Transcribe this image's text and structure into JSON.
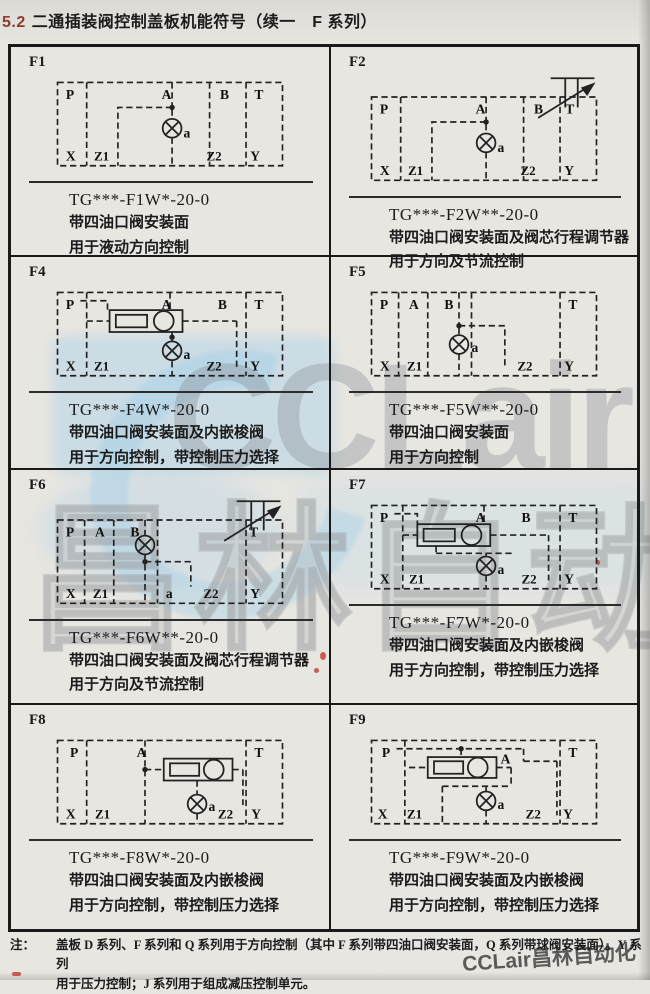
{
  "page": {
    "background": "#e7e6e1",
    "table_border": "#1a1a1a",
    "accent_num_color": "#8a3c2e"
  },
  "header": {
    "num": "5.2",
    "title": "二通插装阀控制盖板机能符号（续一　F 系列）"
  },
  "watermark": {
    "brand": "CCLair",
    "brand_cn": "昌林自动化",
    "corner": "CCLair昌林自动化",
    "blue": "#9ecdec",
    "gray": "#80868c"
  },
  "note": {
    "prefix": "注：",
    "line1": "盖板 D 系列、F 系列和 Q 系列用于方向控制（其中 F 系列带四油口阀安装面，Q 系列带球阀安装面）。Y 系列",
    "line2": "用于压力控制；J 系列用于组成减压控制单元。"
  },
  "cells": [
    {
      "id": "F1",
      "model": "TG***-F1W*-20-0",
      "desc1": "带四油口阀安装面",
      "desc2": "用于液动方向控制",
      "ports": {
        "p": "P",
        "a_top": "A",
        "b": "B",
        "t": "T",
        "x": "X",
        "z1": "Z1",
        "a": "a",
        "z2": "Z2",
        "y": "Y"
      }
    },
    {
      "id": "F2",
      "model": "TG***-F2W**-20-0",
      "desc1": "带四油口阀安装面及阀芯行程调节器",
      "desc2": "用于方向及节流控制",
      "ports": {
        "p": "P",
        "a_top": "A",
        "b": "B",
        "t": "T",
        "x": "X",
        "z1": "Z1",
        "a": "a",
        "z2": "Z2",
        "y": "Y"
      }
    },
    {
      "id": "F4",
      "model": "TG***-F4W*-20-0",
      "desc1": "带四油口阀安装面及内嵌梭阀",
      "desc2": "用于方向控制，带控制压力选择",
      "ports": {
        "p": "P",
        "a_top": "A",
        "b": "B",
        "t": "T",
        "x": "X",
        "z1": "Z1",
        "a": "a",
        "z2": "Z2",
        "y": "Y"
      }
    },
    {
      "id": "F5",
      "model": "TG***-F5W**-20-0",
      "desc1": "带四油口阀安装面",
      "desc2": "用于方向控制",
      "ports": {
        "p": "P",
        "a_top": "A",
        "b": "B",
        "t": "T",
        "x": "X",
        "z1": "Z1",
        "a": "a",
        "z2": "Z2",
        "y": "Y"
      }
    },
    {
      "id": "F6",
      "model": "TG***-F6W**-20-0",
      "desc1": "带四油口阀安装面及阀芯行程调节器",
      "desc2": "用于方向及节流控制",
      "ports": {
        "p": "P",
        "a_top": "A",
        "b": "B",
        "t": "T",
        "x": "X",
        "z1": "Z1",
        "a": "a",
        "z2": "Z2",
        "y": "Y"
      }
    },
    {
      "id": "F7",
      "model": "TG***-F7W*-20-0",
      "desc1": "带四油口阀安装面及内嵌梭阀",
      "desc2": "用于方向控制，带控制压力选择",
      "ports": {
        "p": "P",
        "a_top": "A",
        "b": "B",
        "t": "T",
        "x": "X",
        "z1": "Z1",
        "a": "a",
        "z2": "Z2",
        "y": "Y"
      }
    },
    {
      "id": "F8",
      "model": "TG***-F8W*-20-0",
      "desc1": "带四油口阀安装面及内嵌梭阀",
      "desc2": "用于方向控制，带控制压力选择",
      "ports": {
        "p": "P",
        "a_top": "A",
        "t": "T",
        "x": "X",
        "z1": "Z1",
        "a": "a",
        "z2": "Z2",
        "y": "Y"
      }
    },
    {
      "id": "F9",
      "model": "TG***-F9W*-20-0",
      "desc1": "带四油口阀安装面及内嵌梭阀",
      "desc2": "用于方向控制，带控制压力选择",
      "ports": {
        "p": "P",
        "a_mid": "A",
        "t": "T",
        "x": "X",
        "z1": "Z1",
        "a": "a",
        "z2": "Z2",
        "y": "Y"
      }
    }
  ]
}
